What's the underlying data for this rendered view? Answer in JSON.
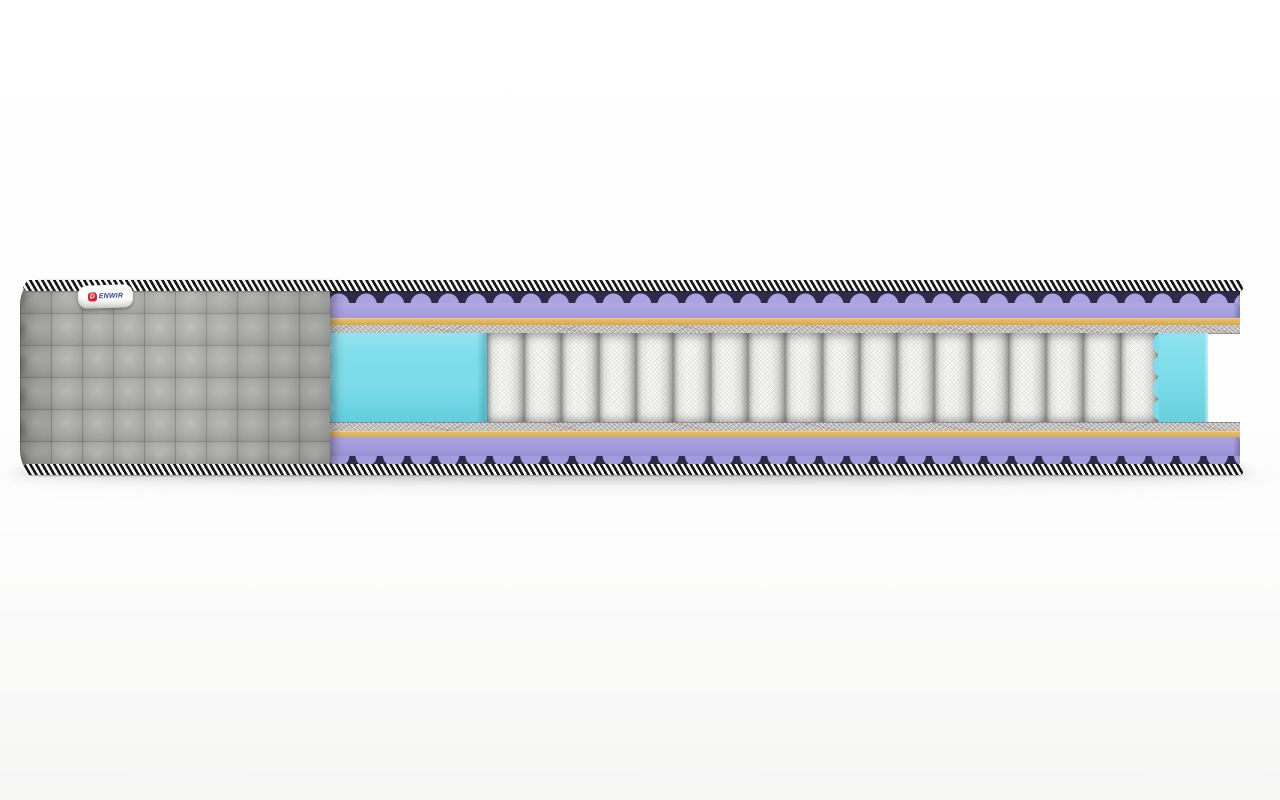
{
  "image": {
    "type": "product-render",
    "subject": "mattress cross-section cutaway"
  },
  "brand": {
    "logo_letter": "D",
    "tag_text": "ENWIR"
  },
  "colors": {
    "tapeDark": "#161616",
    "tapeLight": "#f6f6f4",
    "coverGray": "#a8a8a6",
    "foamPurple": "#aaa3e0",
    "foamPurpleDeep": "#2f2a4a",
    "latexOrange": "#d7a94e",
    "latexOrangeLight": "#e7bd66",
    "latexOrangeDark": "#96731f",
    "feltGray": "#c9c8c5",
    "springWhite": "#fbfbf9",
    "springGap": "#8e8e8c",
    "foamCyan": "#7cdce9",
    "foamCyanDeep": "#4fc3d6",
    "tagWhite": "#ffffff",
    "logoRed": "#d8232a",
    "logoBlue": "#27418c",
    "floorShadow": "#3c3c3c"
  },
  "structure": {
    "visible_spring_count": 18,
    "left_section": "quilted-gray-fabric-cover",
    "side_support_blocks": "cyan-foam",
    "layers_top_to_bottom": [
      "edge-tape",
      "wavy-purple-foam",
      "purple-foam",
      "orange-latex",
      "felt-pad",
      "pocket-spring-core-with-cyan-foam-sides",
      "felt-pad",
      "orange-latex",
      "purple-foam",
      "wavy-purple-foam",
      "edge-tape"
    ]
  }
}
